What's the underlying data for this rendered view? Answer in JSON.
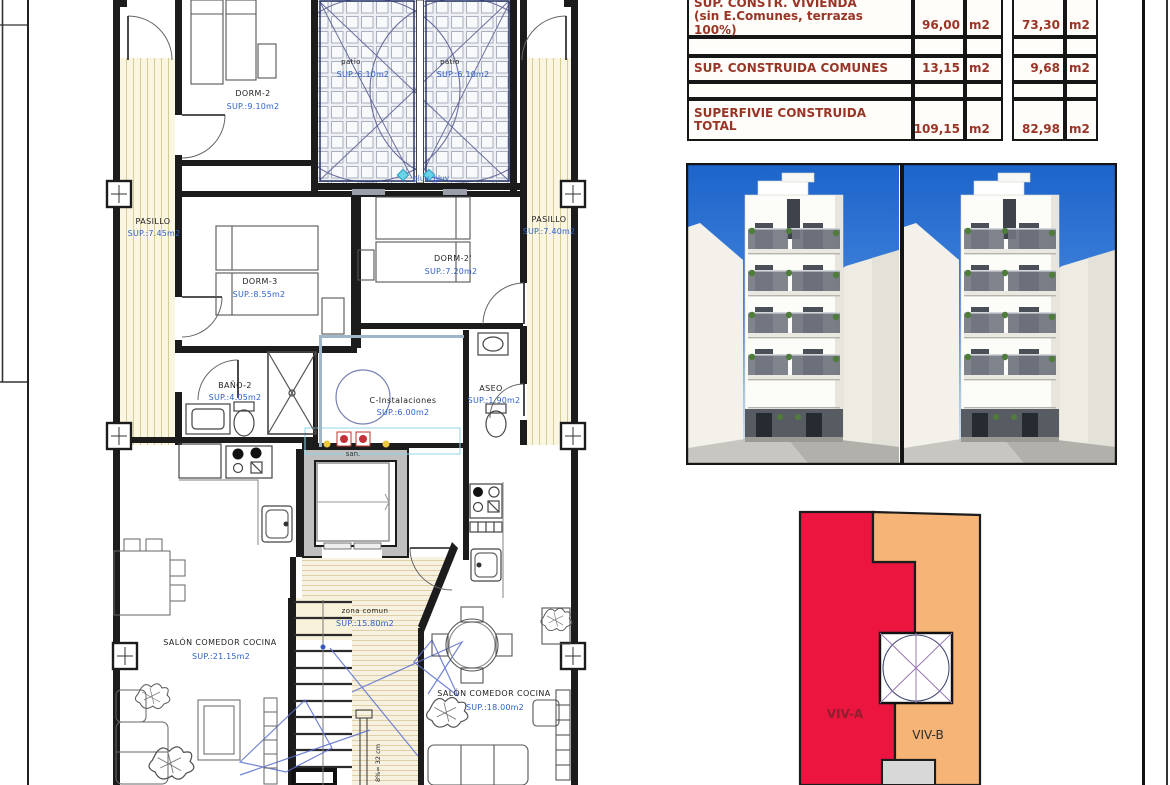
{
  "table": {
    "rows": [
      {
        "label1": "SUP. CONSTR. VIVIENDA",
        "label2": "(sin E.Comunes, terrazas 100%)",
        "value_a": "96,00",
        "unit_a": "m2",
        "value_b": "73,30",
        "unit_b": "m2"
      },
      {
        "label1": "SUP. CONSTRUIDA COMUNES",
        "label2": "",
        "value_a": "13,15",
        "unit_a": "m2",
        "value_b": "9,68",
        "unit_b": "m2"
      },
      {
        "label1": "SUPERFIVIE CONSTRUIDA",
        "label2": "TOTAL",
        "value_a": "109,15",
        "unit_a": "m2",
        "value_b": "82,98",
        "unit_b": "m2"
      }
    ]
  },
  "plan": {
    "rooms": {
      "dorm2": {
        "name": "DORM-2",
        "sup": "SUP.:9.10m2"
      },
      "patio1": {
        "name": "patio",
        "sup": "SUP.:6.10m2"
      },
      "patio2": {
        "name": "patio",
        "sup": "SUP.:6.10m2"
      },
      "pasillo_left": {
        "name": "PASILLO",
        "sup": "SUP.:7.45m2"
      },
      "pasillo_right": {
        "name": "PASILLO",
        "sup": "SUP.:7.40m2"
      },
      "dorm3": {
        "name": "DORM-3",
        "sup": "SUP.:8.55m2"
      },
      "dorm2b": {
        "name": "DORM-2'",
        "sup": "SUP.:7.20m2"
      },
      "bano2": {
        "name": "BAÑO-2",
        "sup": "SUP.:4.05m2"
      },
      "cinst": {
        "name": "C-Instalaciones",
        "sup": "SUP.:6.00m2"
      },
      "aseo": {
        "name": "ASEO",
        "sup": "SUP.:1.90m2"
      },
      "zona": {
        "name": "zona comun",
        "sup": "SUP.:15.80m2"
      },
      "salon_a": {
        "name": "SALÓN COMEDOR COCINA",
        "sup": "SUP.:21.15m2"
      },
      "salon_b": {
        "name": "SALÓN COMEDOR COCINA",
        "sup": "SUP.:18.00m2"
      }
    },
    "annotations": {
      "pluv": "pluv. pluv.",
      "san": "san.",
      "stair_note": "8%= 32 cm"
    }
  },
  "diagram": {
    "viv_a": "VIV-A",
    "viv_b": "VIV-B"
  },
  "colors": {
    "viv_a_fill": "#ec1540",
    "viv_b_fill": "#f6b576",
    "table_text": "#993527",
    "sup_text": "#2e62c8",
    "sky_top": "#1d64cb"
  }
}
